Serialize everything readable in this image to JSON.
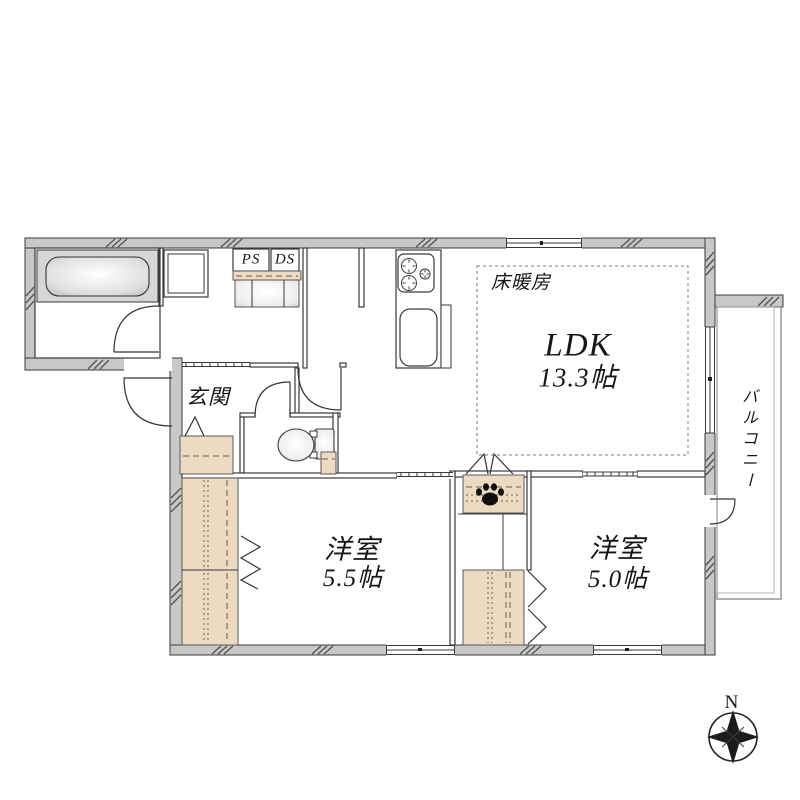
{
  "floorplan": {
    "rooms": {
      "ldk": {
        "name": "LDK",
        "area": "13.3帖"
      },
      "bedroom_a": {
        "name": "洋室",
        "area": "5.5帖"
      },
      "bedroom_b": {
        "name": "洋室",
        "area": "5.0帖"
      },
      "entrance": {
        "name": "玄関"
      },
      "balcony": {
        "name": "バルコニー"
      },
      "floor_heating": {
        "name": "床暖房"
      },
      "pipe_space": {
        "name": "PS"
      },
      "duct_space": {
        "name": "DS"
      }
    },
    "compass": {
      "north_label": "N"
    },
    "colors": {
      "background": "#ffffff",
      "wall_fill": "#c8c8c8",
      "wall_line": "#3a3a3a",
      "closet_fill": "#ecdbc0",
      "fixture_gray": "#d6d6d6",
      "paw": "#101010"
    }
  }
}
